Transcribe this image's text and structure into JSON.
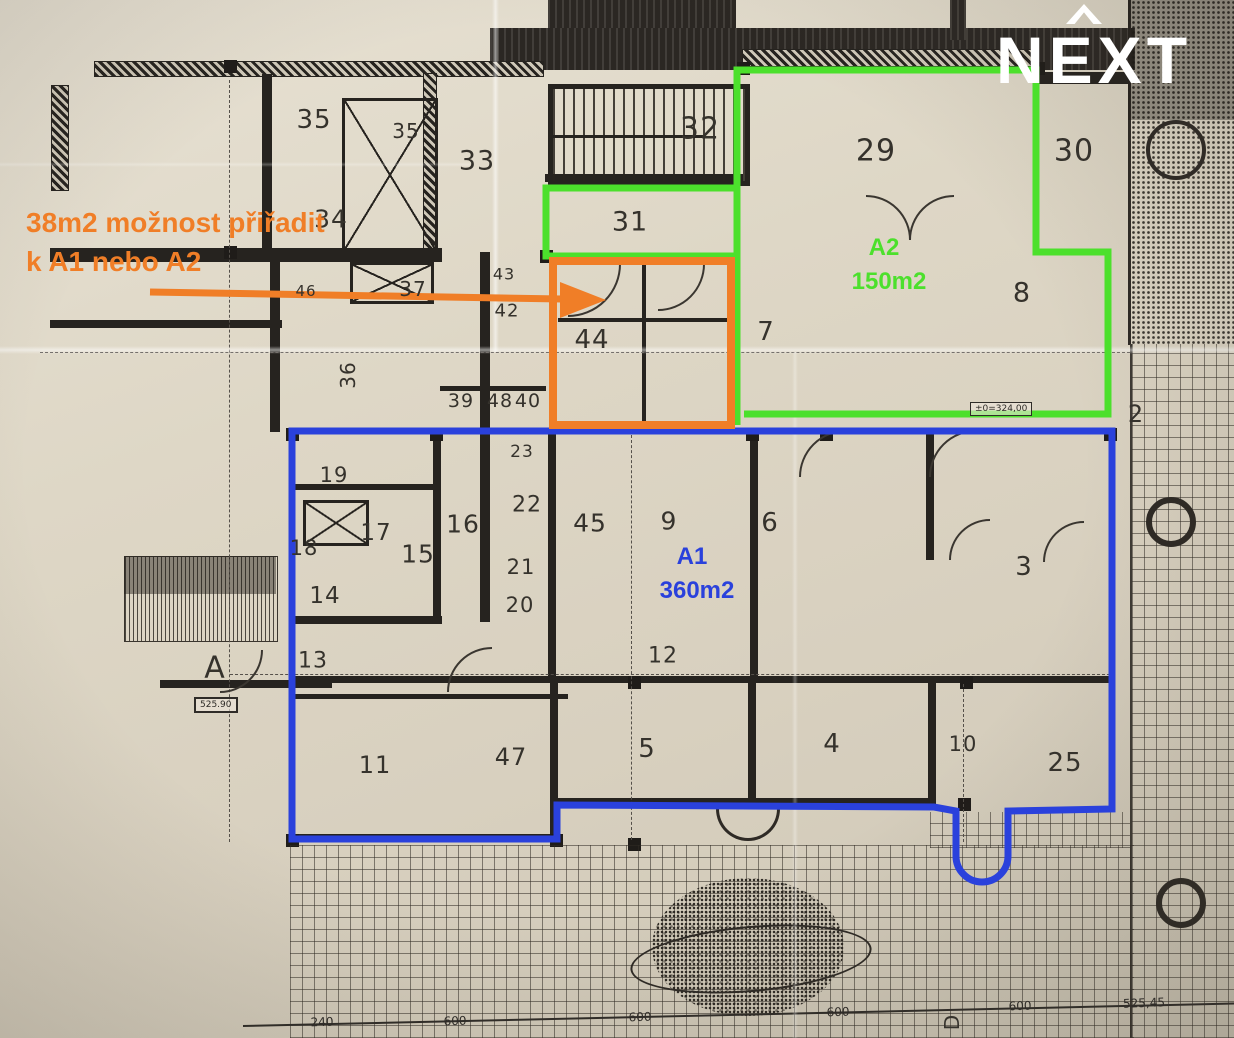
{
  "logo": {
    "text": "NEXT"
  },
  "note": {
    "line1": "38m2 možnost přiřadit",
    "line2": "k A1 nebo A2"
  },
  "zones": {
    "a1": {
      "name": "A1",
      "area": "360m2",
      "color": "#2A41DC"
    },
    "a2": {
      "name": "A2",
      "area": "150m2",
      "color": "#4CE02C"
    },
    "option": {
      "color": "#F07E27"
    }
  },
  "markers": {
    "section_a": "A",
    "level": "525.90",
    "elevation": "±0=324,00",
    "section_d": "D"
  },
  "rooms": [
    {
      "label": "35",
      "x": 314,
      "y": 120,
      "fs": 26
    },
    {
      "label": "35",
      "x": 406,
      "y": 131,
      "fs": 20
    },
    {
      "label": "33",
      "x": 477,
      "y": 161,
      "fs": 27
    },
    {
      "label": "34",
      "x": 331,
      "y": 219,
      "fs": 25
    },
    {
      "label": "32",
      "x": 700,
      "y": 129,
      "fs": 30
    },
    {
      "label": "31",
      "x": 630,
      "y": 222,
      "fs": 27
    },
    {
      "label": "29",
      "x": 876,
      "y": 151,
      "fs": 30
    },
    {
      "label": "30",
      "x": 1074,
      "y": 151,
      "fs": 30
    },
    {
      "label": "8",
      "x": 1022,
      "y": 293,
      "fs": 27
    },
    {
      "label": "7",
      "x": 766,
      "y": 332,
      "fs": 26
    },
    {
      "label": "44",
      "x": 592,
      "y": 340,
      "fs": 26
    },
    {
      "label": "2",
      "x": 1136,
      "y": 414,
      "fs": 24
    },
    {
      "label": "43",
      "x": 504,
      "y": 274,
      "fs": 16
    },
    {
      "label": "42",
      "x": 507,
      "y": 311,
      "fs": 18
    },
    {
      "label": "37",
      "x": 413,
      "y": 289,
      "fs": 20
    },
    {
      "label": "46",
      "x": 306,
      "y": 291,
      "fs": 15
    },
    {
      "label": "36",
      "x": 348,
      "y": 375,
      "fs": 20,
      "r": -90
    },
    {
      "label": "39",
      "x": 461,
      "y": 401,
      "fs": 19
    },
    {
      "label": "48",
      "x": 500,
      "y": 401,
      "fs": 19
    },
    {
      "label": "40",
      "x": 528,
      "y": 401,
      "fs": 19
    },
    {
      "label": "23",
      "x": 522,
      "y": 452,
      "fs": 17
    },
    {
      "label": "19",
      "x": 334,
      "y": 475,
      "fs": 21
    },
    {
      "label": "18",
      "x": 304,
      "y": 548,
      "fs": 21
    },
    {
      "label": "17",
      "x": 376,
      "y": 533,
      "fs": 23
    },
    {
      "label": "16",
      "x": 463,
      "y": 524,
      "fs": 25
    },
    {
      "label": "15",
      "x": 418,
      "y": 554,
      "fs": 25
    },
    {
      "label": "22",
      "x": 527,
      "y": 505,
      "fs": 22
    },
    {
      "label": "21",
      "x": 521,
      "y": 567,
      "fs": 21
    },
    {
      "label": "20",
      "x": 520,
      "y": 605,
      "fs": 21
    },
    {
      "label": "14",
      "x": 325,
      "y": 596,
      "fs": 23
    },
    {
      "label": "45",
      "x": 590,
      "y": 523,
      "fs": 25
    },
    {
      "label": "9",
      "x": 669,
      "y": 521,
      "fs": 25
    },
    {
      "label": "6",
      "x": 770,
      "y": 523,
      "fs": 26
    },
    {
      "label": "3",
      "x": 1024,
      "y": 567,
      "fs": 26
    },
    {
      "label": "13",
      "x": 313,
      "y": 661,
      "fs": 22
    },
    {
      "label": "12",
      "x": 663,
      "y": 656,
      "fs": 22
    },
    {
      "label": "11",
      "x": 375,
      "y": 765,
      "fs": 24
    },
    {
      "label": "47",
      "x": 511,
      "y": 757,
      "fs": 24
    },
    {
      "label": "5",
      "x": 647,
      "y": 749,
      "fs": 26
    },
    {
      "label": "4",
      "x": 832,
      "y": 744,
      "fs": 26
    },
    {
      "label": "10",
      "x": 963,
      "y": 744,
      "fs": 21
    },
    {
      "label": "25",
      "x": 1065,
      "y": 763,
      "fs": 26
    }
  ],
  "dimensions": [
    {
      "label": "240",
      "x": 322,
      "y": 1022
    },
    {
      "label": "600",
      "x": 455,
      "y": 1021
    },
    {
      "label": "600",
      "x": 640,
      "y": 1017
    },
    {
      "label": "600",
      "x": 838,
      "y": 1012
    },
    {
      "label": "600",
      "x": 1020,
      "y": 1006
    },
    {
      "label": "525,45",
      "x": 1144,
      "y": 1003
    }
  ]
}
